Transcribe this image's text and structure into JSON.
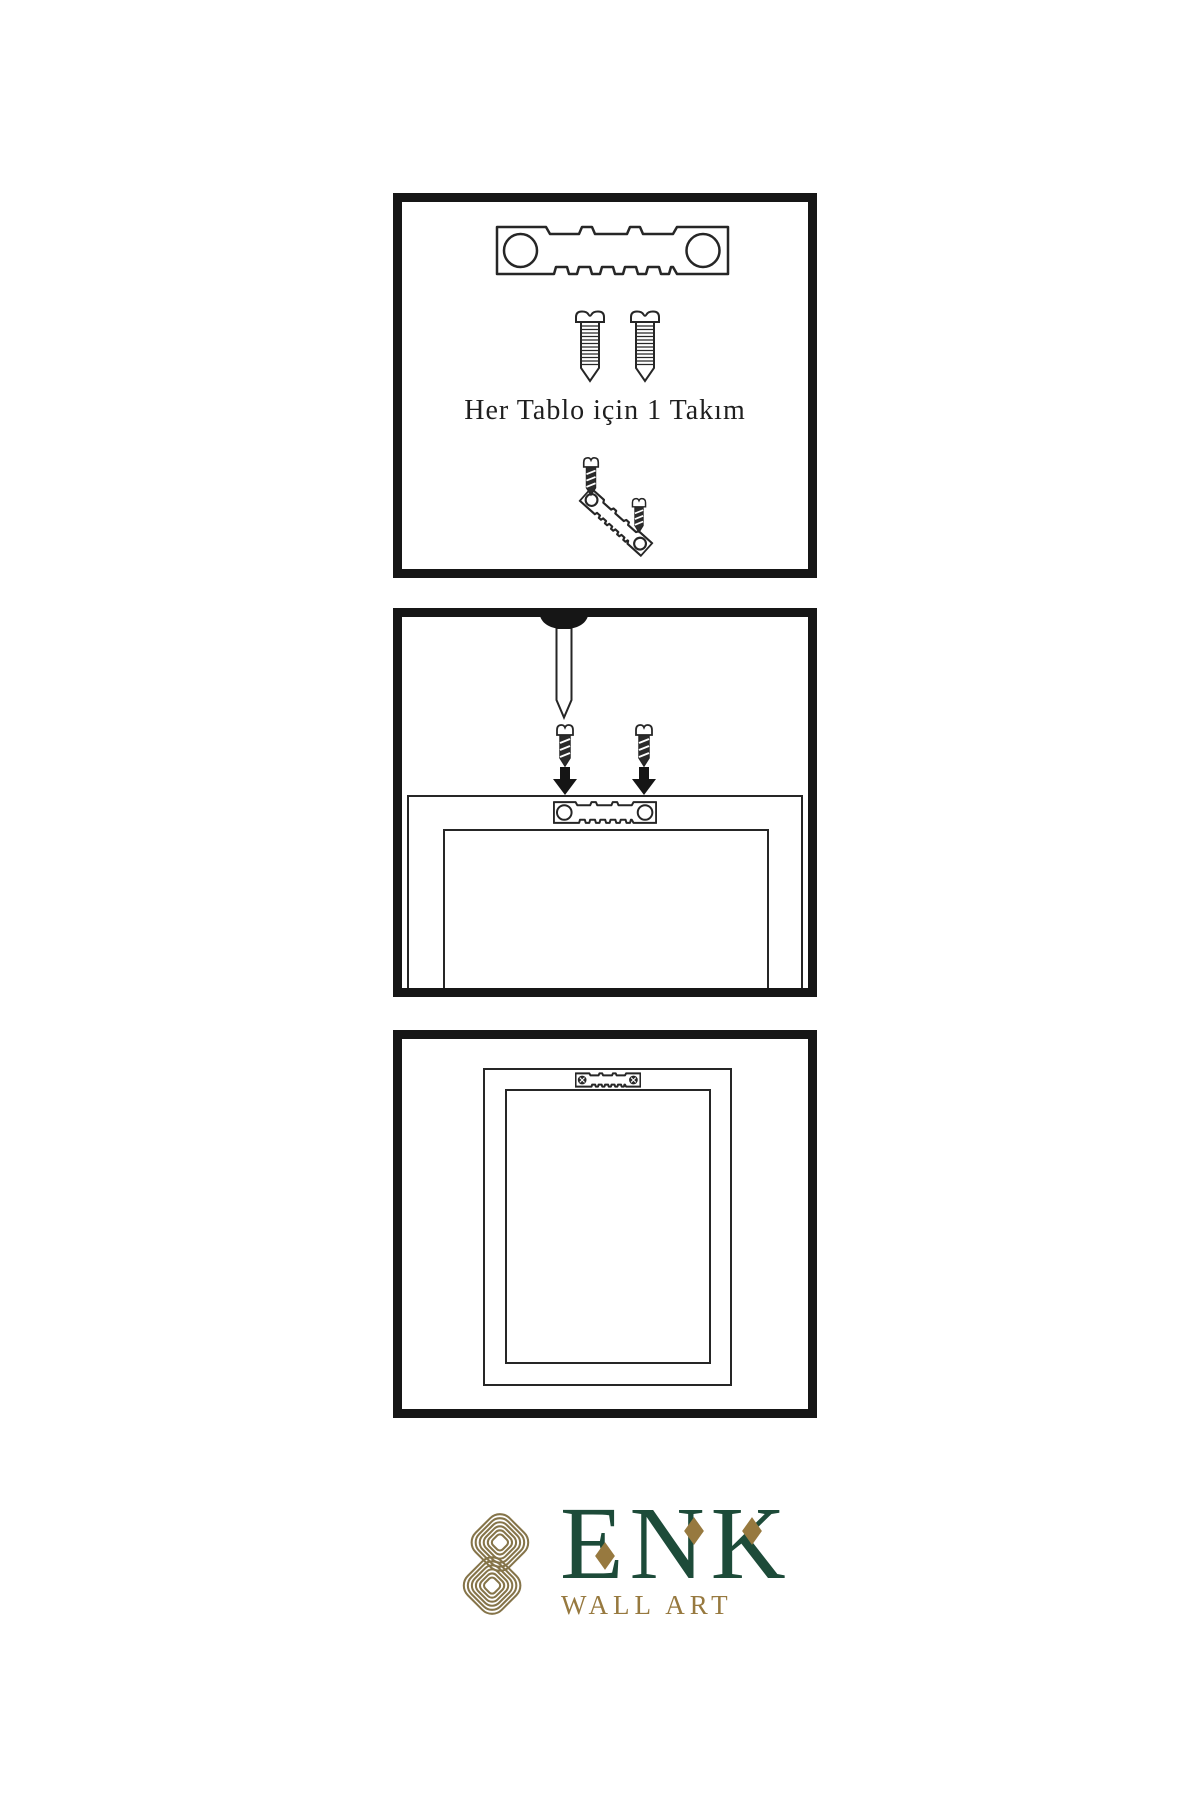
{
  "panels": {
    "kit": {
      "caption": "Her Tablo için 1 Takım"
    }
  },
  "logo": {
    "name": "ENK",
    "subtitle": "WALL ART",
    "colors": {
      "green": "#1d4b39",
      "gold": "#97793f",
      "knot": "#857449"
    }
  },
  "drawing": {
    "ink": "#262626",
    "panel_border": "#161616"
  }
}
